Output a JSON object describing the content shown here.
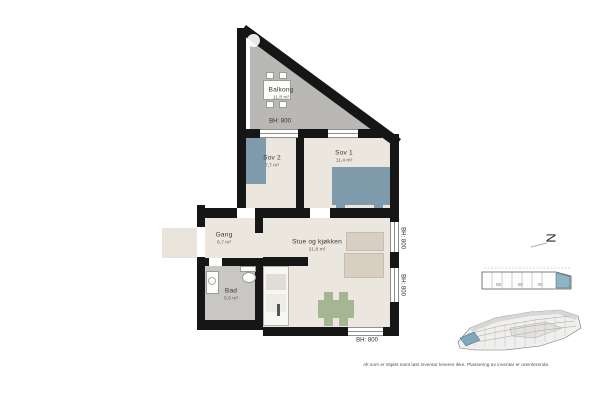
{
  "plan": {
    "rooms": [
      {
        "name": "Balkong",
        "area": "11,8 m²"
      },
      {
        "name": "Sov 2",
        "area": "7,7 m²"
      },
      {
        "name": "Sov 1",
        "area": "11,4 m²"
      },
      {
        "name": "Gang",
        "area": "6,7 m²"
      },
      {
        "name": "Stue og kjøkken",
        "area": "21,8 m²"
      },
      {
        "name": "Bad",
        "area": "5,5 m²"
      }
    ],
    "bh_labels": [
      "BH: 800",
      "BH: 800",
      "BH: 800",
      "BH: 800"
    ],
    "north_label": "N"
  },
  "footnote": "Alt som er stiplet samt løst inventar leveres ikke. Plassering av inventar er orienterende.",
  "colors": {
    "wall": "#161616",
    "balcony_floor": "#b9b8b5",
    "interior_floor": "#ebe6de",
    "bath_floor": "#c8c7c3",
    "furniture_blue": "#7e9aab",
    "dining_green": "#a4b694",
    "sofa_beige": "#d6cfc2",
    "unit_highlight": "#8fb4c6"
  }
}
